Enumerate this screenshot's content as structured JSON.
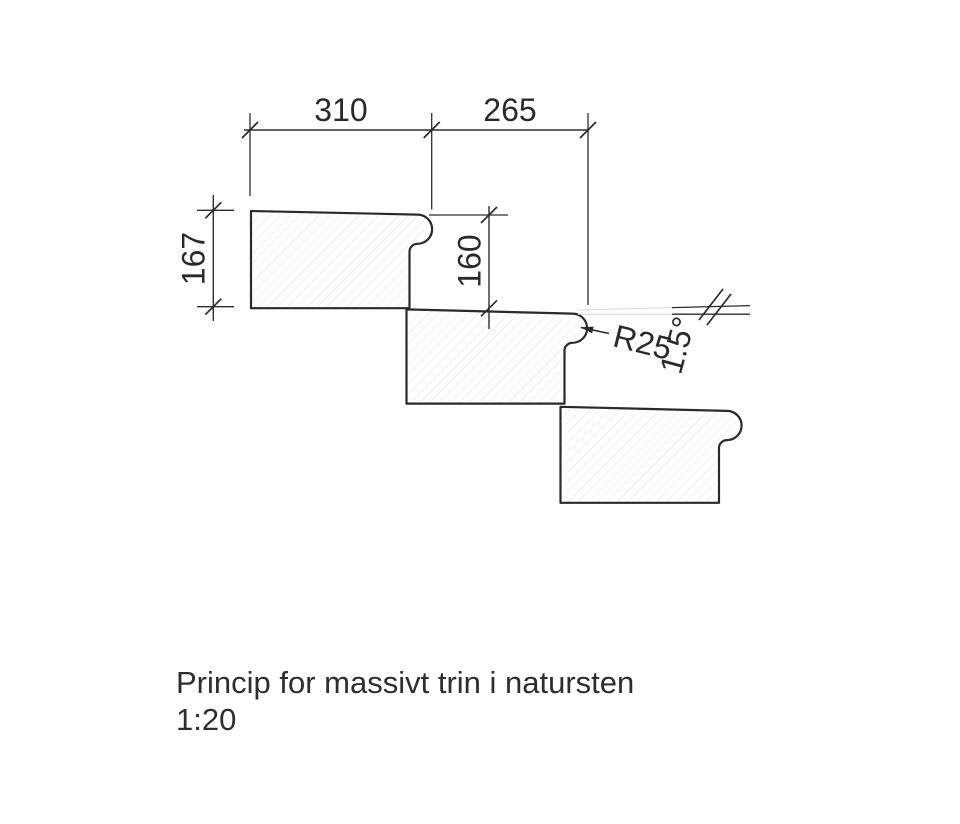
{
  "drawing": {
    "dimensions": {
      "tread_top": "310",
      "going_nose": "265",
      "block_height_left": "167",
      "riser_height": "160",
      "nose_radius": "R25",
      "slope_angle": "1.5°"
    },
    "caption": {
      "title": "Princip for massivt trin i natursten",
      "scale": "1:20"
    },
    "colors": {
      "outline": "#2a2a2a",
      "dimension_line": "#2e2e2e",
      "hatch": "#e2e2e2",
      "faint_reference": "#d9d9d9",
      "background": "#ffffff",
      "text": "#2a2a2a"
    }
  }
}
